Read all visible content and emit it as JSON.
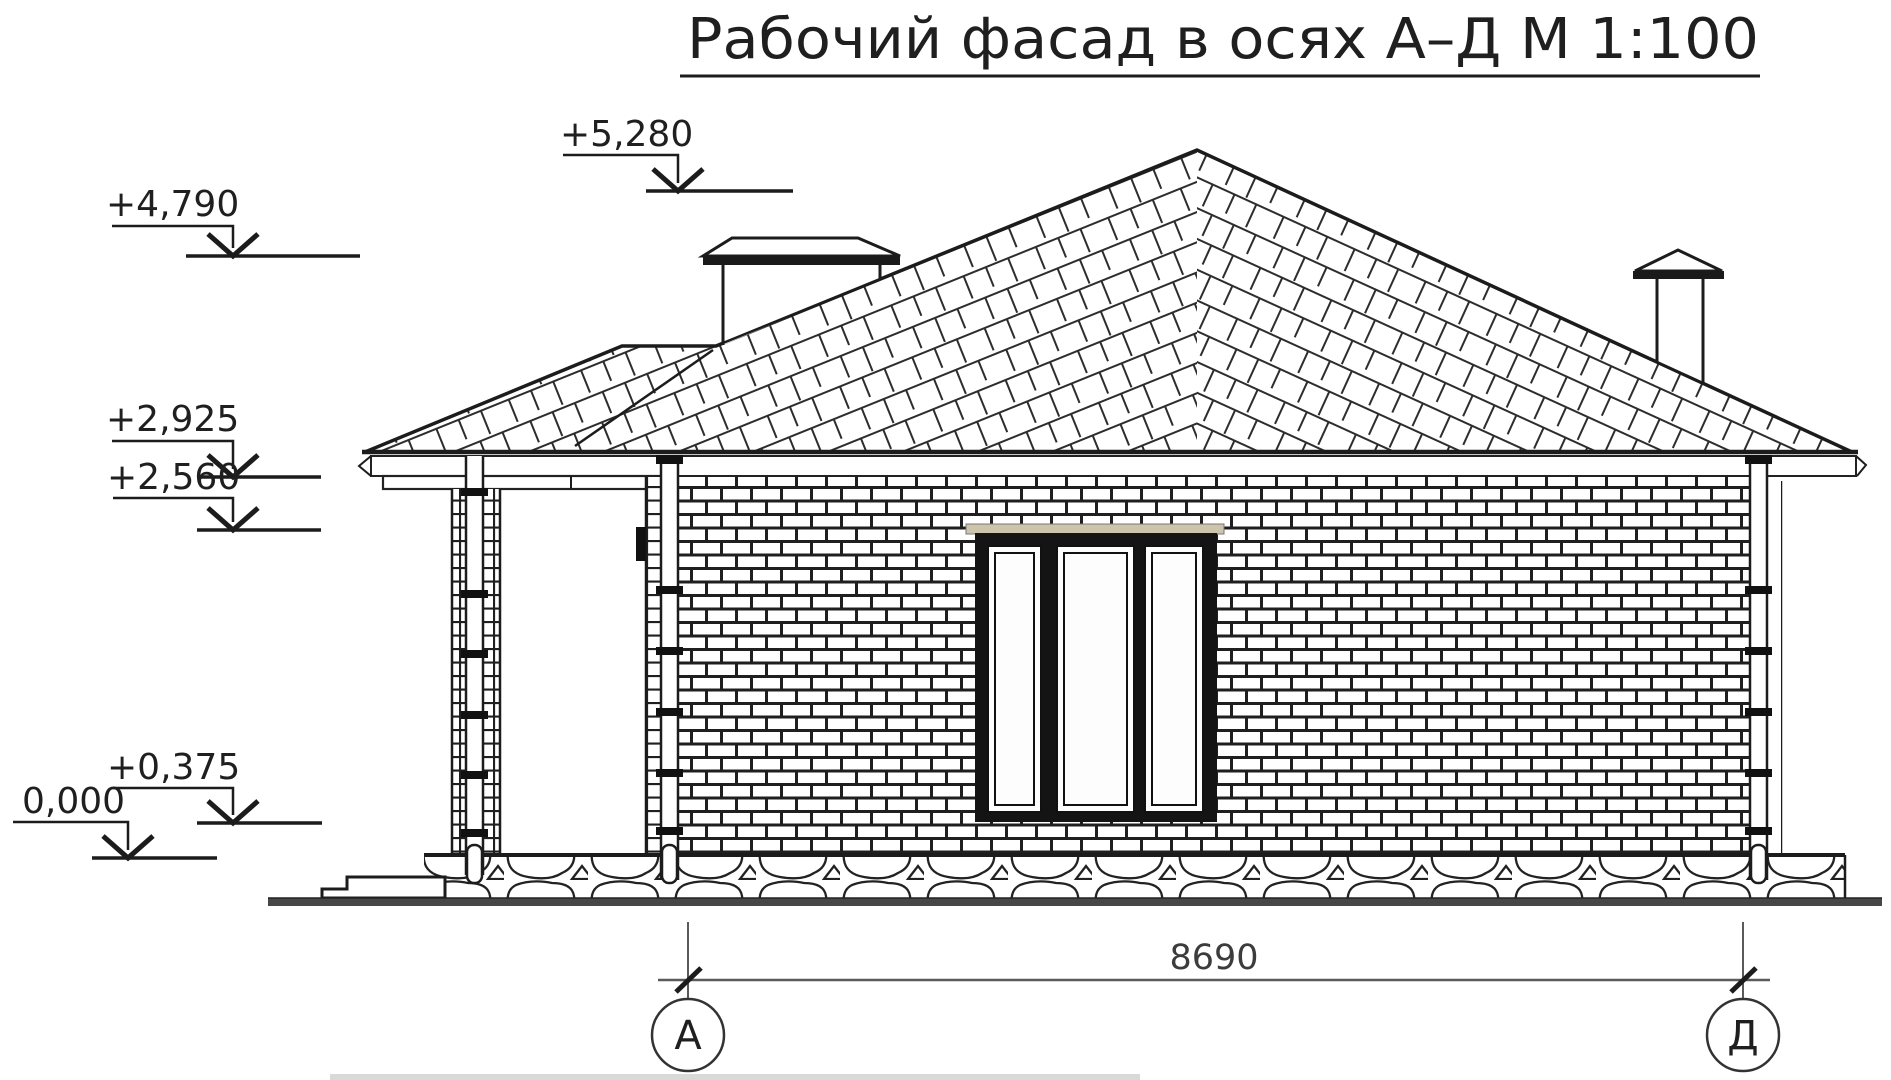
{
  "drawing_title": "Рабочий фасад в осях А–Д М 1:100",
  "elevation_marks": [
    {
      "label": "+5,280"
    },
    {
      "label": "+4,790"
    },
    {
      "label": "+2,925"
    },
    {
      "label": "+2,560"
    },
    {
      "label": "+0,375"
    },
    {
      "label": "0,000"
    }
  ],
  "dimension": {
    "span": "8690"
  },
  "axes": {
    "left_label": "А",
    "right_label": "Д"
  },
  "colors": {
    "linework": "#1c1c1c",
    "dimension_lines": "#5a5a5a",
    "window_lintel": "#cdc5ab",
    "ground_band": "#474747"
  }
}
